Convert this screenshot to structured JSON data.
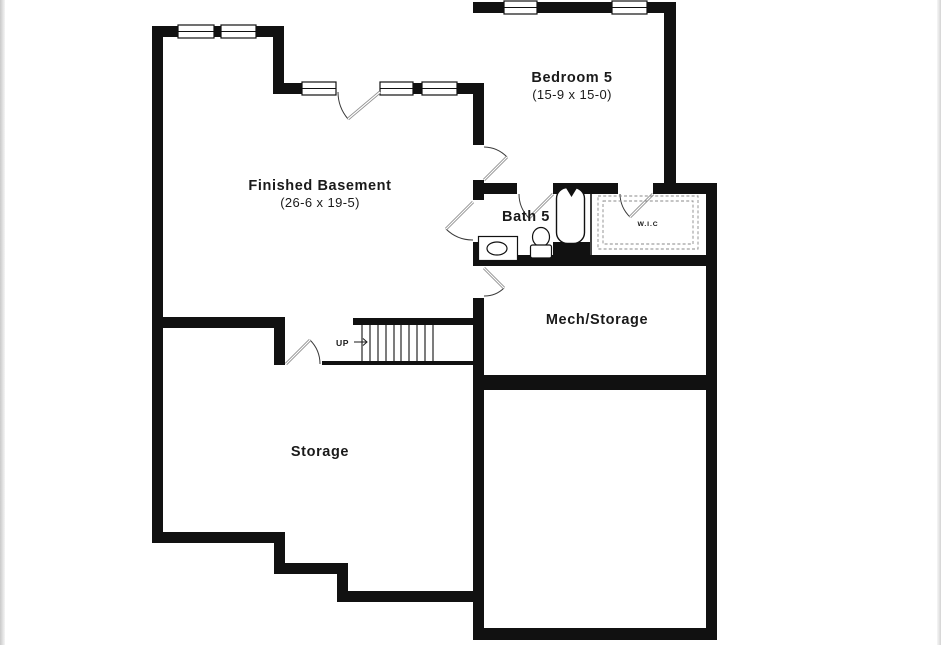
{
  "floorplan": {
    "level": "basement",
    "rooms": {
      "finished_basement": {
        "label": "Finished Basement",
        "dims": "(26-6 x 19-5)"
      },
      "bedroom5": {
        "label": "Bedroom 5",
        "dims": "(15-9 x 15-0)"
      },
      "bath5": {
        "label": "Bath 5"
      },
      "wic": {
        "label": "W.I.C"
      },
      "mech_storage": {
        "label": "Mech/Storage"
      },
      "storage": {
        "label": "Storage"
      }
    },
    "stairs": {
      "label": "UP",
      "direction": "up"
    },
    "fixtures": [
      "bathtub",
      "toilet",
      "vanity-sink",
      "closet-shelving"
    ],
    "colors": {
      "wall": "#111111",
      "text": "#1a1a1a",
      "door_leaf": "#8f8f8f",
      "background": "#ffffff"
    }
  }
}
